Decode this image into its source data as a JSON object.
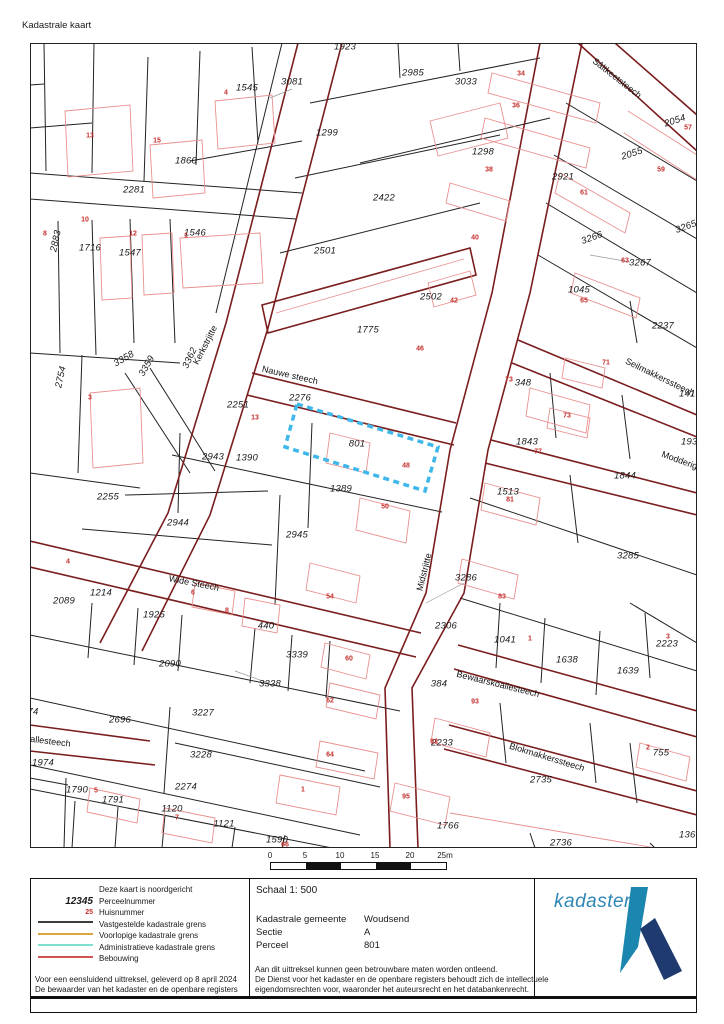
{
  "title": "Kadastrale kaart",
  "map": {
    "highlighted_parcel": "801",
    "highlight_color": "#3eb7ea",
    "parcel_numbers": [
      {
        "t": "1923",
        "x": 315,
        "y": 4
      },
      {
        "t": "2985",
        "x": 383,
        "y": 30
      },
      {
        "t": "3033",
        "x": 436,
        "y": 39
      },
      {
        "t": "3081",
        "x": 262,
        "y": 39
      },
      {
        "t": "1545",
        "x": 217,
        "y": 45
      },
      {
        "t": "1299",
        "x": 297,
        "y": 90
      },
      {
        "t": "1298",
        "x": 453,
        "y": 109
      },
      {
        "t": "2054",
        "x": 645,
        "y": 78,
        "r": -18
      },
      {
        "t": "2055",
        "x": 602,
        "y": 111,
        "r": -18
      },
      {
        "t": "2921",
        "x": 533,
        "y": 134
      },
      {
        "t": "1860",
        "x": 156,
        "y": 118
      },
      {
        "t": "2281",
        "x": 104,
        "y": 147
      },
      {
        "t": "2422",
        "x": 354,
        "y": 155
      },
      {
        "t": "2883",
        "x": 26,
        "y": 198,
        "r": -78
      },
      {
        "t": "1716",
        "x": 60,
        "y": 205
      },
      {
        "t": "1547",
        "x": 100,
        "y": 210
      },
      {
        "t": "1546",
        "x": 165,
        "y": 190
      },
      {
        "t": "2501",
        "x": 295,
        "y": 208
      },
      {
        "t": "3266",
        "x": 562,
        "y": 195,
        "r": -20
      },
      {
        "t": "3265",
        "x": 656,
        "y": 184,
        "r": -20
      },
      {
        "t": "3267",
        "x": 610,
        "y": 220
      },
      {
        "t": "1045",
        "x": 549,
        "y": 247
      },
      {
        "t": "2237",
        "x": 633,
        "y": 283
      },
      {
        "t": "2502",
        "x": 401,
        "y": 254
      },
      {
        "t": "1775",
        "x": 338,
        "y": 287
      },
      {
        "t": "2754",
        "x": 31,
        "y": 334,
        "r": -78
      },
      {
        "t": "3358",
        "x": 94,
        "y": 316,
        "r": -30
      },
      {
        "t": "3359",
        "x": 117,
        "y": 323,
        "r": -60
      },
      {
        "t": "3362",
        "x": 160,
        "y": 315,
        "r": -65
      },
      {
        "t": "2251",
        "x": 208,
        "y": 362
      },
      {
        "t": "2276",
        "x": 270,
        "y": 355
      },
      {
        "t": "801",
        "x": 327,
        "y": 401
      },
      {
        "t": "2943",
        "x": 183,
        "y": 414
      },
      {
        "t": "1390",
        "x": 217,
        "y": 415
      },
      {
        "t": "1389",
        "x": 311,
        "y": 446
      },
      {
        "t": "348",
        "x": 493,
        "y": 340
      },
      {
        "t": "1843",
        "x": 497,
        "y": 399
      },
      {
        "t": "1938",
        "x": 662,
        "y": 399
      },
      {
        "t": "1844",
        "x": 595,
        "y": 433
      },
      {
        "t": "1513",
        "x": 478,
        "y": 449
      },
      {
        "t": "1419",
        "x": 660,
        "y": 351
      },
      {
        "t": "3285",
        "x": 598,
        "y": 513
      },
      {
        "t": "2944",
        "x": 148,
        "y": 480
      },
      {
        "t": "2945",
        "x": 267,
        "y": 492
      },
      {
        "t": "2255",
        "x": 78,
        "y": 454
      },
      {
        "t": "2089",
        "x": 34,
        "y": 558
      },
      {
        "t": "1214",
        "x": 71,
        "y": 550
      },
      {
        "t": "1925",
        "x": 124,
        "y": 572
      },
      {
        "t": "440",
        "x": 236,
        "y": 583
      },
      {
        "t": "3286",
        "x": 436,
        "y": 535
      },
      {
        "t": "2306",
        "x": 416,
        "y": 583
      },
      {
        "t": "1041",
        "x": 475,
        "y": 597
      },
      {
        "t": "1638",
        "x": 537,
        "y": 617
      },
      {
        "t": "1639",
        "x": 598,
        "y": 628
      },
      {
        "t": "2223",
        "x": 637,
        "y": 601
      },
      {
        "t": "384",
        "x": 409,
        "y": 641
      },
      {
        "t": "3339",
        "x": 267,
        "y": 612
      },
      {
        "t": "3338",
        "x": 240,
        "y": 641
      },
      {
        "t": "2090",
        "x": 140,
        "y": 621
      },
      {
        "t": "2696",
        "x": 90,
        "y": 677
      },
      {
        "t": "3227",
        "x": 173,
        "y": 670
      },
      {
        "t": "3228",
        "x": 171,
        "y": 712
      },
      {
        "t": "2274",
        "x": 156,
        "y": 744
      },
      {
        "t": "1974",
        "x": 13,
        "y": 720
      },
      {
        "t": "1790",
        "x": 47,
        "y": 747
      },
      {
        "t": "1791",
        "x": 83,
        "y": 757
      },
      {
        "t": "1120",
        "x": 142,
        "y": 766
      },
      {
        "t": "1121",
        "x": 194,
        "y": 781
      },
      {
        "t": "1590",
        "x": 247,
        "y": 797
      },
      {
        "t": "2233",
        "x": 412,
        "y": 700
      },
      {
        "t": "2735",
        "x": 511,
        "y": 737
      },
      {
        "t": "755",
        "x": 631,
        "y": 710
      },
      {
        "t": "1766",
        "x": 418,
        "y": 783
      },
      {
        "t": "2736",
        "x": 531,
        "y": 800
      },
      {
        "t": "1360",
        "x": 660,
        "y": 792
      },
      {
        "t": "74",
        "x": 3,
        "y": 669
      }
    ],
    "house_numbers": [
      {
        "t": "13",
        "x": 60,
        "y": 93
      },
      {
        "t": "15",
        "x": 127,
        "y": 98
      },
      {
        "t": "4",
        "x": 196,
        "y": 50
      },
      {
        "t": "34",
        "x": 491,
        "y": 31
      },
      {
        "t": "36",
        "x": 486,
        "y": 63
      },
      {
        "t": "38",
        "x": 459,
        "y": 127
      },
      {
        "t": "57",
        "x": 658,
        "y": 85
      },
      {
        "t": "59",
        "x": 631,
        "y": 127
      },
      {
        "t": "61",
        "x": 554,
        "y": 150
      },
      {
        "t": "40",
        "x": 445,
        "y": 195
      },
      {
        "t": "42",
        "x": 424,
        "y": 258
      },
      {
        "t": "46",
        "x": 390,
        "y": 306
      },
      {
        "t": "63",
        "x": 595,
        "y": 218
      },
      {
        "t": "65",
        "x": 554,
        "y": 258
      },
      {
        "t": "8",
        "x": 15,
        "y": 191
      },
      {
        "t": "10",
        "x": 55,
        "y": 177
      },
      {
        "t": "12",
        "x": 103,
        "y": 191
      },
      {
        "t": "1",
        "x": 156,
        "y": 193
      },
      {
        "t": "3",
        "x": 60,
        "y": 355
      },
      {
        "t": "13",
        "x": 225,
        "y": 375
      },
      {
        "t": "48",
        "x": 376,
        "y": 423
      },
      {
        "t": "50",
        "x": 355,
        "y": 464
      },
      {
        "t": "71",
        "x": 576,
        "y": 320
      },
      {
        "t": "73",
        "x": 479,
        "y": 337
      },
      {
        "t": "73",
        "x": 537,
        "y": 373
      },
      {
        "t": "77",
        "x": 508,
        "y": 409
      },
      {
        "t": "81",
        "x": 480,
        "y": 457
      },
      {
        "t": "83",
        "x": 472,
        "y": 554
      },
      {
        "t": "54",
        "x": 300,
        "y": 554
      },
      {
        "t": "6",
        "x": 163,
        "y": 550
      },
      {
        "t": "8",
        "x": 197,
        "y": 568
      },
      {
        "t": "4",
        "x": 38,
        "y": 519
      },
      {
        "t": "1",
        "x": 500,
        "y": 596
      },
      {
        "t": "3",
        "x": 638,
        "y": 594
      },
      {
        "t": "2",
        "x": 618,
        "y": 705
      },
      {
        "t": "60",
        "x": 319,
        "y": 616
      },
      {
        "t": "62",
        "x": 300,
        "y": 658
      },
      {
        "t": "64",
        "x": 300,
        "y": 712
      },
      {
        "t": "93",
        "x": 445,
        "y": 659
      },
      {
        "t": "93",
        "x": 404,
        "y": 699
      },
      {
        "t": "95",
        "x": 376,
        "y": 754
      },
      {
        "t": "1",
        "x": 273,
        "y": 747
      },
      {
        "t": "5",
        "x": 66,
        "y": 748
      },
      {
        "t": "7",
        "x": 147,
        "y": 775
      },
      {
        "t": "66",
        "x": 255,
        "y": 802
      }
    ],
    "street_names": [
      {
        "t": "Sâltkeetsteech",
        "x": 587,
        "y": 35,
        "r": 38
      },
      {
        "t": "Kerkstrjitte",
        "x": 175,
        "y": 302,
        "r": -63
      },
      {
        "t": "Nauwe steech",
        "x": 260,
        "y": 332,
        "r": 13
      },
      {
        "t": "Seilmakkerssteech",
        "x": 630,
        "y": 334,
        "r": 26
      },
      {
        "t": "Modderige",
        "x": 652,
        "y": 418,
        "r": 20
      },
      {
        "t": "Wide Steech",
        "x": 164,
        "y": 540,
        "r": 11
      },
      {
        "t": "Midstrjitte",
        "x": 394,
        "y": 529,
        "r": -76
      },
      {
        "t": "Bewaarskoallesteech",
        "x": 468,
        "y": 641,
        "r": 14
      },
      {
        "t": "Blokmakkerssteech",
        "x": 517,
        "y": 714,
        "r": 17
      },
      {
        "t": "oallesteech",
        "x": 18,
        "y": 698,
        "r": 7
      }
    ]
  },
  "scalebar": {
    "ticks": [
      "0",
      "5",
      "10",
      "15",
      "20",
      "25m"
    ],
    "segments": [
      "#ffffff",
      "#111111",
      "#ffffff",
      "#111111",
      "#ffffff"
    ]
  },
  "legend": {
    "items": [
      {
        "sample": "none",
        "label": "Deze kaart is noordgericht"
      },
      {
        "sample": "big-number",
        "sample_text": "12345",
        "label": "Perceelnummer"
      },
      {
        "sample": "red-number",
        "sample_text": "25",
        "label": "Huisnummer"
      },
      {
        "sample": "line",
        "color": "#3c3c3c",
        "label": "Vastgestelde kadastrale grens"
      },
      {
        "sample": "line",
        "color": "#dca73e",
        "label": "Voorlopige kadastrale grens"
      },
      {
        "sample": "line",
        "color": "#7fe0cf",
        "label": "Administratieve kadastrale grens"
      },
      {
        "sample": "line",
        "color": "#d05252",
        "label": "Bebouwing"
      }
    ]
  },
  "info": {
    "scale_label": "Schaal 1: 500",
    "rows": [
      {
        "label": "Kadastrale gemeente",
        "value": "Woudsend"
      },
      {
        "label": "Sectie",
        "value": "A"
      },
      {
        "label": "Perceel",
        "value": "801"
      }
    ]
  },
  "footer": {
    "left1": "Voor een eensluidend uittreksel, geleverd op 8 april 2024",
    "left2": "De bewaarder van het kadaster en de openbare registers",
    "right1": "Aan dit uittreksel kunnen geen betrouwbare maten worden ontleend.",
    "right2": "De Dienst voor het kadaster en de openbare registers behoudt zich de intellectuele",
    "right3": "eigendomsrechten voor, waaronder het auteursrecht en het databankenrecht."
  },
  "logo": {
    "text": "kadaster",
    "text_color": "#2e86b5",
    "pen_color": "#1b87ae",
    "diag_color": "#1f3a6e"
  }
}
